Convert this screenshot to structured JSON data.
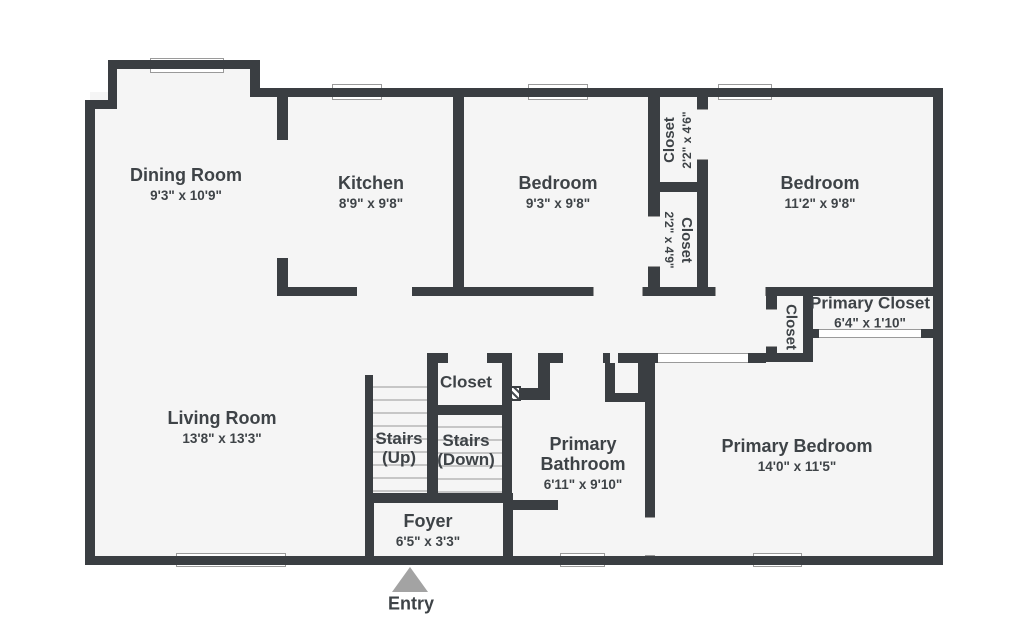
{
  "title": "Floor plan",
  "colors": {
    "wall": "#3a3e42",
    "floor": "#f5f5f5",
    "background": "#ffffff",
    "text": "#3e4347",
    "entry_arrow": "#a3a3a3",
    "stair_line": "#c6c6c6",
    "window_line": "#9a9a9a"
  },
  "rooms": {
    "dining": {
      "name": "Dining Room",
      "dims": "9'3\" x 10'9\""
    },
    "kitchen": {
      "name": "Kitchen",
      "dims": "8'9\" x 9'8\""
    },
    "bedroom_left": {
      "name": "Bedroom",
      "dims": "9'3\" x 9'8\""
    },
    "closet_upper": {
      "name": "Closet",
      "dims": "2'2\" x 4'6\""
    },
    "closet_lower": {
      "name": "Closet",
      "dims": "2'2\" x 4'9\""
    },
    "bedroom_right": {
      "name": "Bedroom",
      "dims": "11'2\" x 9'8\""
    },
    "primary_closet": {
      "name": "Primary Closet",
      "dims": "6'4\" x 1'10\""
    },
    "closet_hall_small": {
      "name": "Closet",
      "dims": ""
    },
    "living": {
      "name": "Living Room",
      "dims": "13'8\" x 13'3\""
    },
    "hall_closet": {
      "name": "Closet",
      "dims": ""
    },
    "stairs_up": {
      "name": "Stairs (Up)",
      "dims": ""
    },
    "stairs_down": {
      "name": "Stairs (Down)",
      "dims": ""
    },
    "primary_bath": {
      "name": "Primary Bathroom",
      "dims": "6'11\" x 9'10\""
    },
    "primary_bed": {
      "name": "Primary Bedroom",
      "dims": "14'0\" x 11'5\""
    },
    "foyer": {
      "name": "Foyer",
      "dims": "6'5\" x 3'3\""
    }
  },
  "entry": {
    "label": "Entry"
  }
}
